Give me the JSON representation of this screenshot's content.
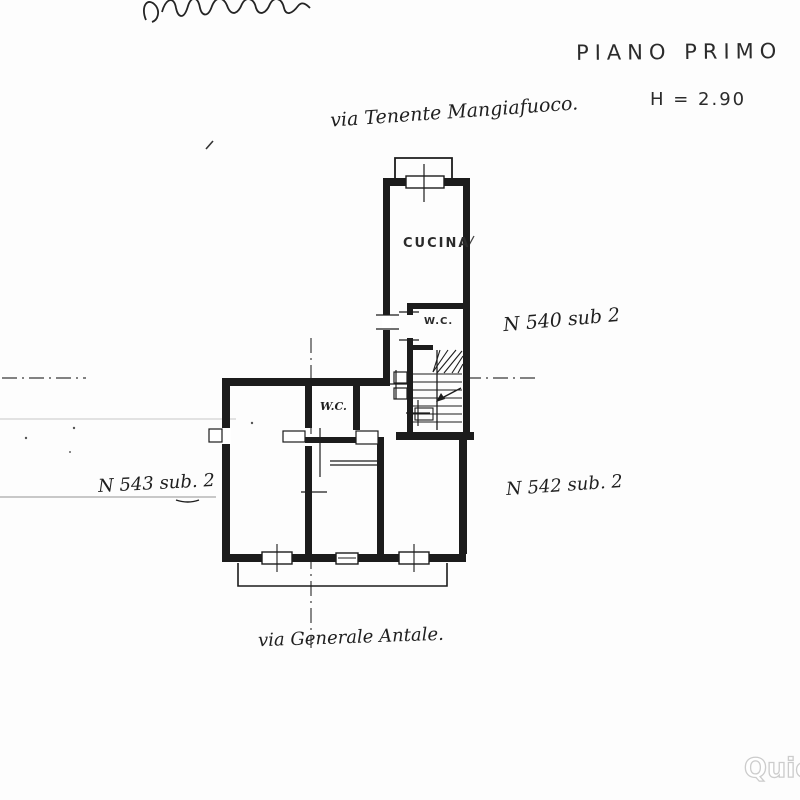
{
  "page": {
    "plan_title": "PIANO PRIMO",
    "height_label": "H = 2.90",
    "street_top": "via Tenente Mangiafuoco.",
    "street_bottom": "via Generale Antale.",
    "unit_labels": {
      "top": "N 540 sub 2",
      "left": "N 543 sub. 2",
      "right": "N 542 sub. 2"
    },
    "room_labels": {
      "kitchen": "CUCINA",
      "wc_upper": "W.C.",
      "wc_lower": "W.C."
    },
    "watermark": "Quicè",
    "colors": {
      "ink": "#1c1c1c",
      "paper": "#fdfdfd",
      "faint_line": "#c8c8c8",
      "watermark_outline": "#cccccc"
    }
  }
}
